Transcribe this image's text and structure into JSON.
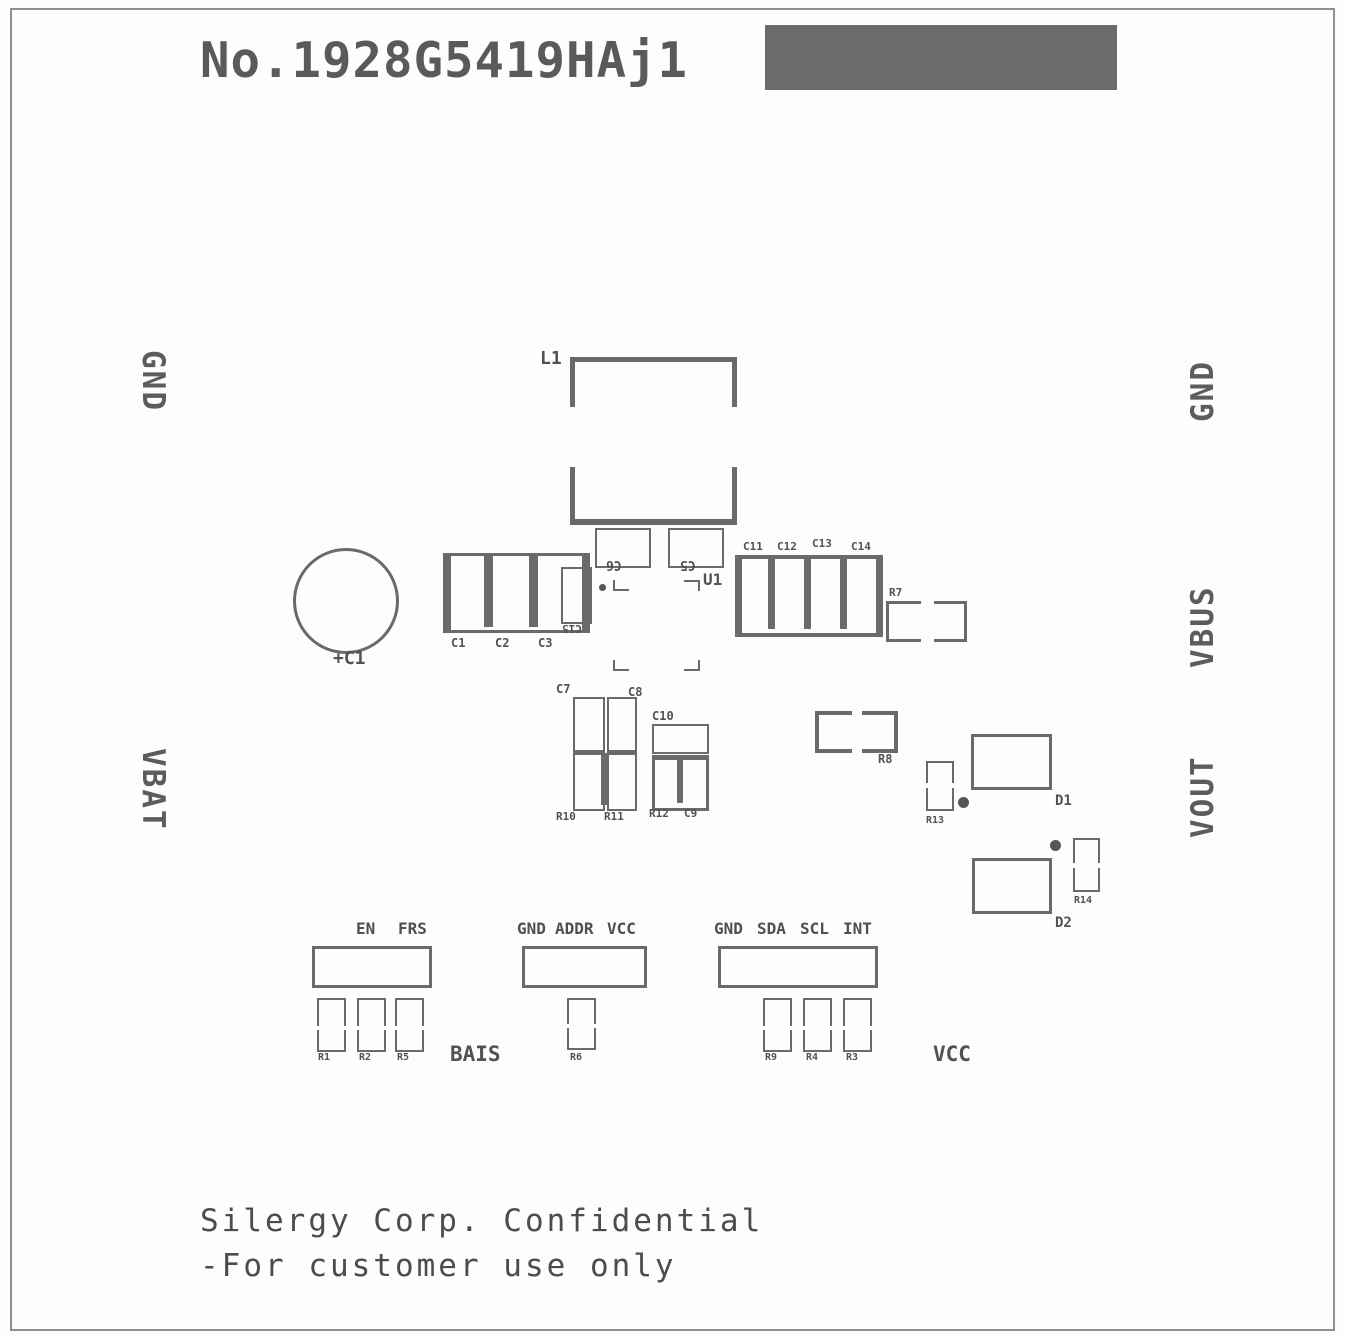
{
  "title": "No.1928G5419HAj1",
  "edge_labels": {
    "left_top": "GND",
    "left_bottom": "VBAT",
    "right_top": "GND",
    "right_mid": "VBUS",
    "right_bottom": "VOUT"
  },
  "components": {
    "l1": "L1",
    "c6": "C6",
    "c5": "C5",
    "u1": "U1",
    "c1_electrolytic": "+C1",
    "cap_left": [
      "C1",
      "C2",
      "C3"
    ],
    "c15": "C15",
    "cap_right": [
      "C11",
      "C12",
      "C13",
      "C14"
    ],
    "r7": "R7",
    "r8": "R8",
    "r13": "R13",
    "r14": "R14",
    "d1": "D1",
    "d2": "D2",
    "c7": "C7",
    "c8": "C8",
    "r10": "R10",
    "r11": "R11",
    "c10": "C10",
    "r12": "R12",
    "c9": "C9"
  },
  "connectors": {
    "left": {
      "pins": [
        "EN",
        "FRS"
      ],
      "resistors": [
        "R1",
        "R2",
        "R5"
      ]
    },
    "middle": {
      "pins": [
        "GND",
        "ADDR",
        "VCC"
      ],
      "resistors": [
        "R6"
      ]
    },
    "right": {
      "pins": [
        "GND",
        "SDA",
        "SCL",
        "INT"
      ],
      "resistors": [
        "R9",
        "R4",
        "R3"
      ]
    }
  },
  "annotations": {
    "bias": "BAIS",
    "vcc": "VCC"
  },
  "footer": {
    "line1": "Silergy Corp. Confidential",
    "line2": "-For customer use only"
  }
}
